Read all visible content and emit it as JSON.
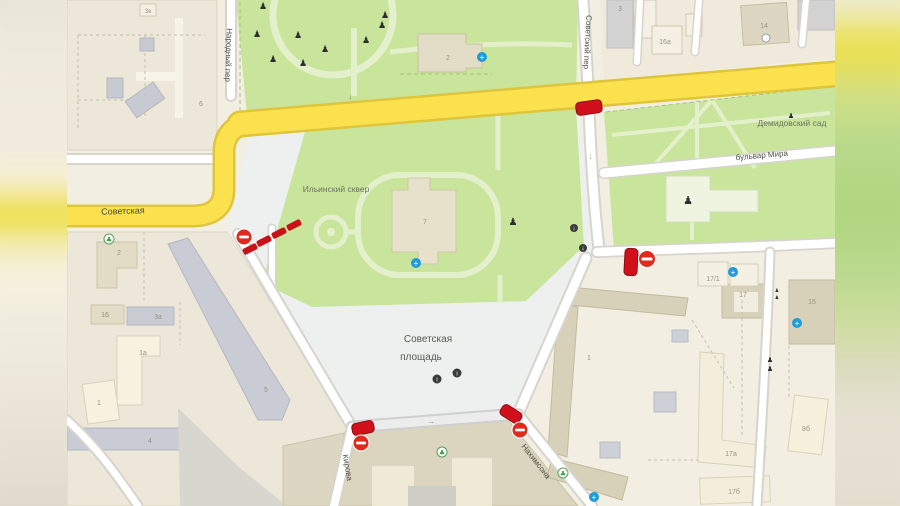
{
  "streets": {
    "sovetskaya": "Советская",
    "narodny_per": "Народный пер",
    "sovetsky_per": "Советский пер",
    "kirova": "Кирова",
    "nakhimsona": "Нахимсона",
    "bulvar_mira": "бульвар Мира"
  },
  "places": {
    "ilyinsky_skver": "Ильинский сквер",
    "demidovsky_sad": "Демидовский сад",
    "square_line1": "Советская",
    "square_line2": "площадь"
  },
  "buildings": {
    "n6": "6",
    "n3v": "3в",
    "n2_top": "2",
    "n3": "3",
    "n16a": "16а",
    "n14": "14",
    "n7": "7",
    "n2": "2",
    "n16": "16",
    "n3a": "3а",
    "n1a": "1а",
    "n1": "1",
    "n5": "5",
    "n4": "4",
    "n1_se": "1",
    "n17": "17",
    "n15": "15",
    "n17_1": "17/1",
    "n17a": "17а",
    "n17b": "17б",
    "n8b": "8б"
  },
  "icons": {
    "monument_glyph": "♟",
    "tree_glyph": "♣",
    "info_glyph": "i",
    "medical_glyph": "+",
    "arrow_glyph": "→"
  },
  "colors": {
    "road_primary_yellow": "#fbe14e",
    "park_green": "#c9e59b",
    "closure_red": "#d2101c",
    "plaza_gray": "#edf0ef",
    "building_tan": "#d8d1ba",
    "poi_blue": "#1f9cd8"
  }
}
